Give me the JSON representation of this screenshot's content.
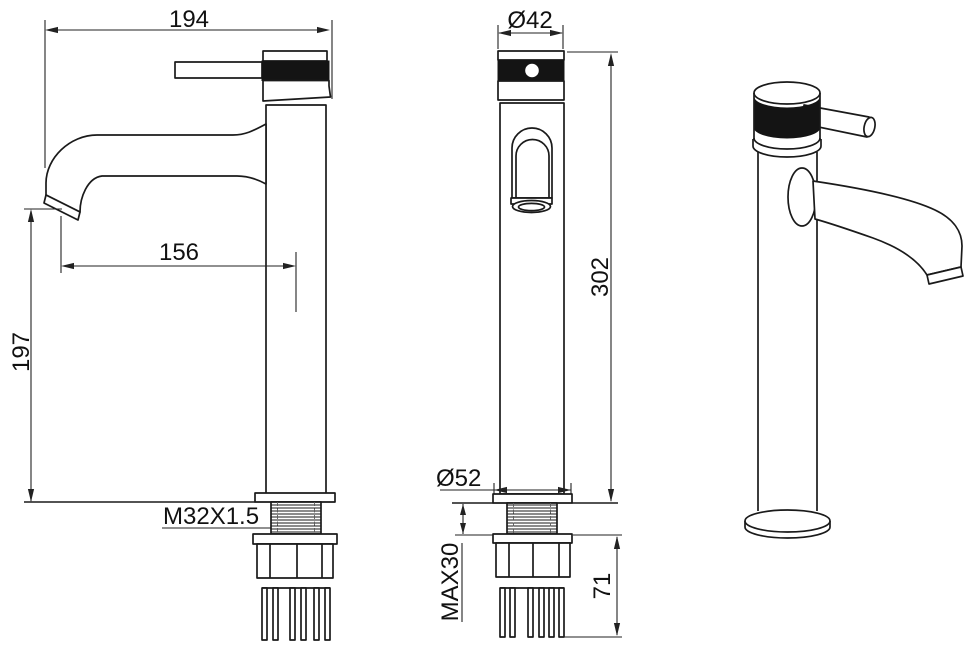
{
  "page": {
    "background": "#ffffff",
    "line_color": "#1a1a1a",
    "knurl_fill": "#141414"
  },
  "drawing": {
    "dimensions": {
      "overall_width": "194",
      "spout_reach": "156",
      "spout_outlet_height": "197",
      "thread_spec": "M32X1.5",
      "handle_diameter": "Ø42",
      "overall_height": "302",
      "base_flange_diameter": "Ø52",
      "max_mounting_thickness": "MAX30",
      "under_counter_length": "71"
    }
  }
}
